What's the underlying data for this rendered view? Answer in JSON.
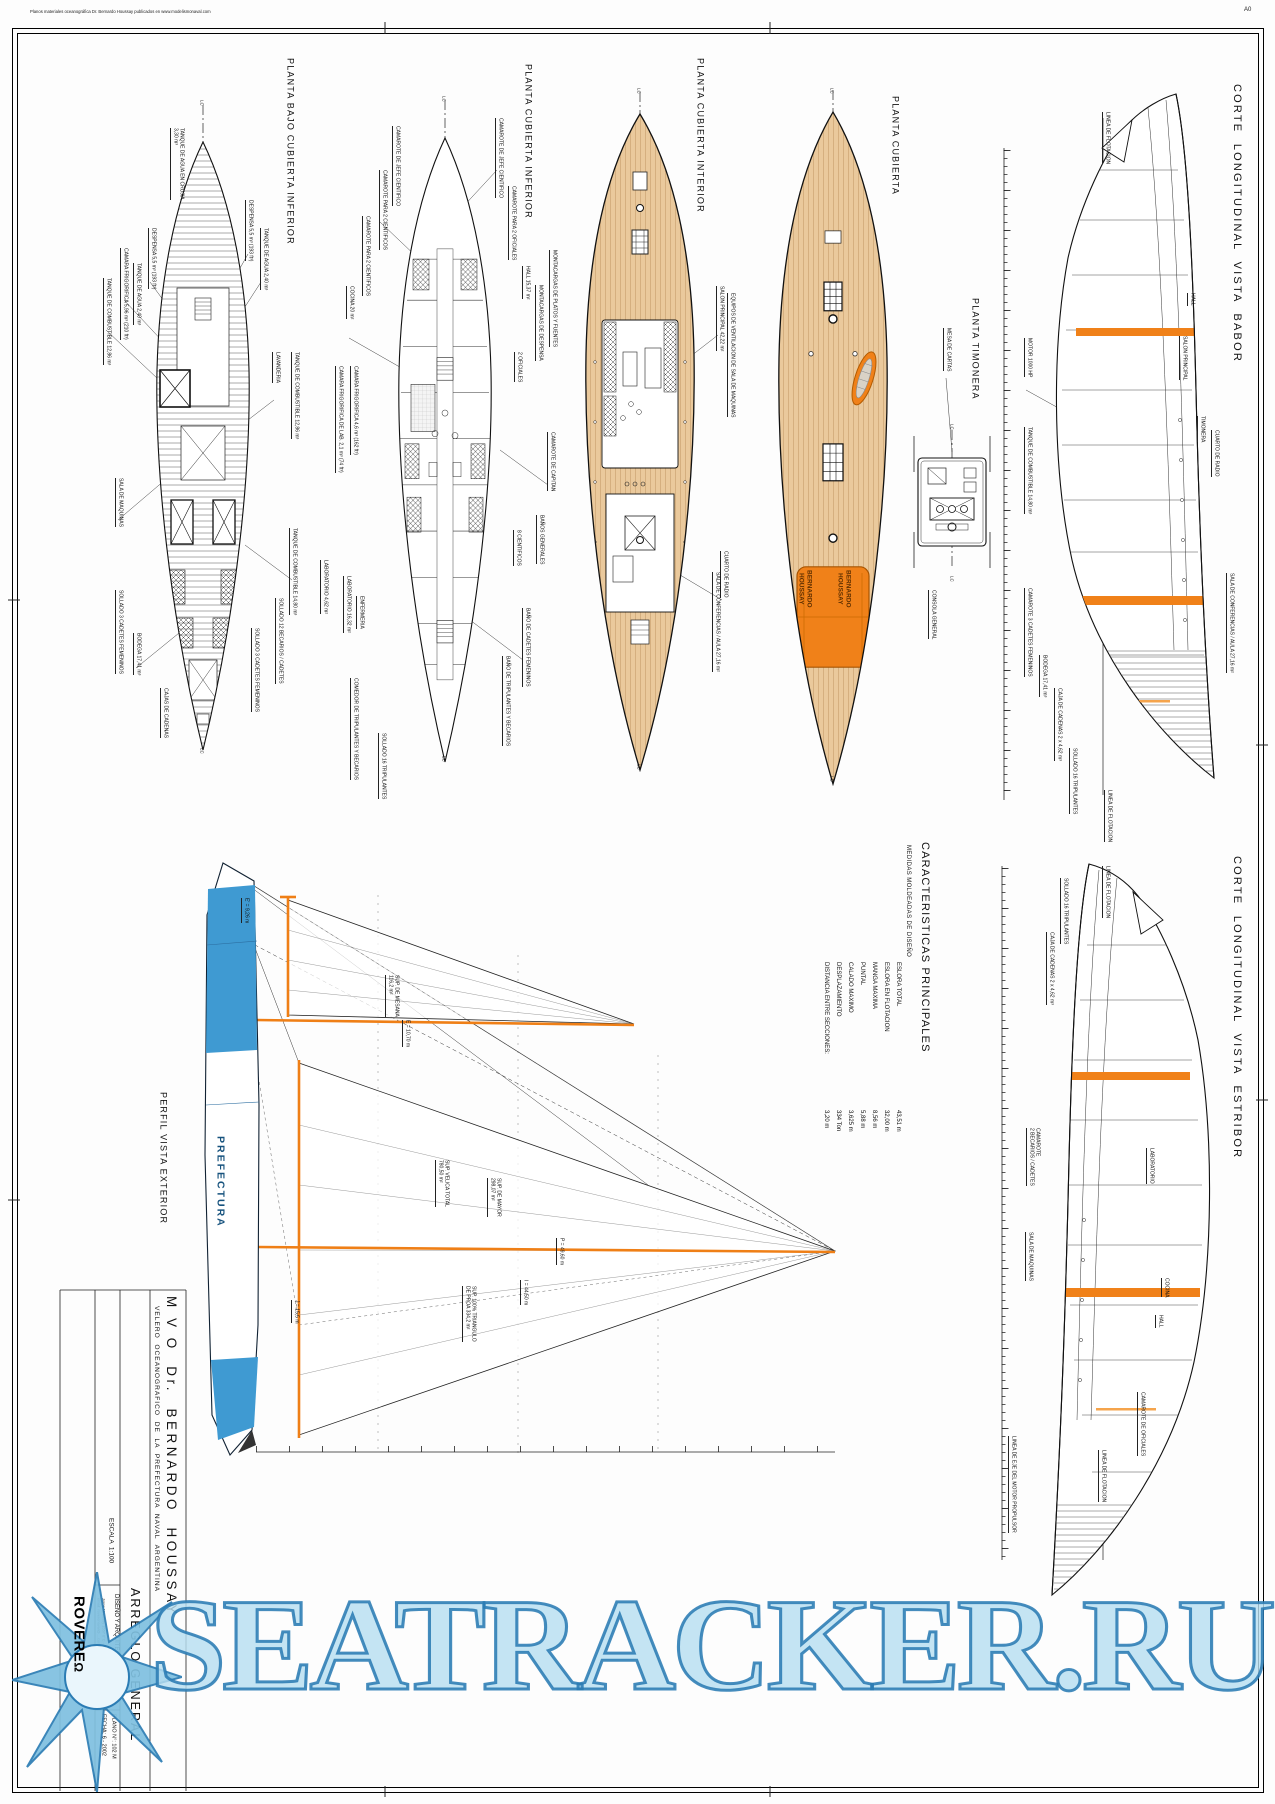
{
  "page": {
    "note": "Planos materiales oceanográfica Dr. Bernardo Houssay publicados en www.modelismonaval.com",
    "sheet_size": "A0"
  },
  "watermark": {
    "text": "SEATRACKER.RU",
    "fill": "#b7def0",
    "stroke": "#2b7cb4"
  },
  "colors": {
    "accent_orange": "#f08119",
    "deck_tan": "#eac99c",
    "hull_blue": "#3f9ad2",
    "watermark_blue": "#2b7cb4",
    "line_black": "#111111"
  },
  "title_block": {
    "vessel_name": "M V O  Dr.  BERNARDO  HOUSSAY",
    "vessel_type": "VELERO  OCEANOGRAFICO  DE  LA  PREFECTURA  NAVAL  ARGENTINA",
    "drawing_title": "ARREGLO GENERAL",
    "scale": "ESCALA  1:100",
    "firm": "DISEÑO Y ARQUITECTURA NAVAL",
    "logo": "ROVERE",
    "logo_mark": "Ω",
    "address1": "Jorge Newbery 1557 6°C - C1426CXA Buenos Aires - Tel.",
    "address2": "email: roverenaval@....com.ar",
    "plan_number": "PLANO N°: 102 M",
    "date": "FECHA: 6 - 2002"
  },
  "characteristics": {
    "title": "CARACTERISTICAS PRINCIPALES",
    "subtitle": "MEDIDAS MOLDEADAS DE DISEÑO",
    "label_y": 962,
    "value_y": 1110,
    "items": [
      {
        "label": "ESLORA TOTAL",
        "value": "43,51 m",
        "x": 894
      },
      {
        "label": "ESLORA EN FLOTACION",
        "value": "32,00 m",
        "x": 882
      },
      {
        "label": "MANGA MAXIMA",
        "value": "8,56 m",
        "x": 870
      },
      {
        "label": "PUNTAL",
        "value": "5,88 m",
        "x": 858
      },
      {
        "label": "CALADO MAXIMO",
        "value": "3,625 m",
        "x": 846
      },
      {
        "label": "DESPLAZAMIENTO",
        "value": "334 Ton",
        "x": 834
      },
      {
        "label": "DISTANCIA ENTRE SECCIONES:",
        "value": "3,20 m",
        "x": 822
      }
    ]
  },
  "callout_groups": [
    {
      "name": "drawing-title",
      "labels": [
        {
          "t": "PLANTA BAJO CUBIERTA INFERIOR",
          "x": 285,
          "y": 58,
          "cls": "tp"
        },
        {
          "t": "PLANTA CUBIERTA INFERIOR",
          "x": 523,
          "y": 64,
          "cls": "tp"
        },
        {
          "t": "PLANTA CUBIERTA INTERIOR",
          "x": 695,
          "y": 58,
          "cls": "tp"
        },
        {
          "t": "PLANTA CUBIERTA",
          "x": 890,
          "y": 96,
          "cls": "tp"
        },
        {
          "t": "PLANTA TIMONERA",
          "x": 970,
          "y": 298,
          "cls": "tp"
        },
        {
          "t": "CORTE  LONGITUDINAL  VISTA  BABOR",
          "x": 1230,
          "y": 84,
          "cls": "ts"
        },
        {
          "t": "CORTE  LONGITUDINAL  VISTA  ESTRIBOR",
          "x": 1230,
          "y": 856,
          "cls": "ts"
        },
        {
          "t": "PERFIL VISTA EXTERIOR",
          "x": 158,
          "y": 1092,
          "cls": "tp"
        }
      ]
    },
    {
      "name": "plan-bajo-cubierta-inferior",
      "labels": [
        {
          "t": "LC",
          "x": 199,
          "y": 100,
          "cls": "lc"
        },
        {
          "t": "TANQUE DE AGUA EN CRUJIA\n3,30 m³",
          "x": 170,
          "y": 128
        },
        {
          "t": "DESPENSA 5,5 m³ (193 ft³)",
          "x": 245,
          "y": 200
        },
        {
          "t": "TANQUE DE AGUA 2,40 m³",
          "x": 260,
          "y": 228
        },
        {
          "t": "DESPENSA 5,5 m³ (193 ft³)",
          "x": 148,
          "y": 228
        },
        {
          "t": "CAMARA FRIGORIFICA 5,96 m³ (210 ft³)",
          "x": 120,
          "y": 248
        },
        {
          "t": "TANQUE DE AGUA 2,40 m³",
          "x": 133,
          "y": 263
        },
        {
          "t": "TANQUE DE COMBUSTIBLE 12,86 m³",
          "x": 103,
          "y": 278
        },
        {
          "t": "LAVANDERIA",
          "x": 272,
          "y": 352
        },
        {
          "t": "TANQUE DE COMBUSTIBLE 12,86 m³",
          "x": 291,
          "y": 352
        },
        {
          "t": "SALA DE MAQUINAS",
          "x": 115,
          "y": 478
        },
        {
          "t": "TANQUE DE COMBUSTIBLE 14,80 m³",
          "x": 289,
          "y": 528
        },
        {
          "t": "SOLLADO 12 BECARIOS / CADETES",
          "x": 275,
          "y": 598
        },
        {
          "t": "SOLLADO 3 CADETES FEMENINOS",
          "x": 115,
          "y": 590
        },
        {
          "t": "BODEGA 17,41 m³",
          "x": 133,
          "y": 633
        },
        {
          "t": "SOLLADO 3 CADETES FEMENINOS",
          "x": 251,
          "y": 628
        },
        {
          "t": "CAJAS DE CADENAS",
          "x": 160,
          "y": 688
        },
        {
          "t": "LC",
          "x": 199,
          "y": 748,
          "cls": "lc"
        }
      ]
    },
    {
      "name": "plan-cubierta-inferior",
      "labels": [
        {
          "t": "LC",
          "x": 441,
          "y": 96,
          "cls": "lc"
        },
        {
          "t": "CAMAROTE DE JEFE CIENTIFICO",
          "x": 495,
          "y": 118
        },
        {
          "t": "CAMAROTE DE JEFE CIENTIFICO",
          "x": 392,
          "y": 126
        },
        {
          "t": "CAMAROTE PARA 2 CIENTIFICOS",
          "x": 379,
          "y": 170
        },
        {
          "t": "CAMAROTE PARA 2 OFICIALES",
          "x": 508,
          "y": 186
        },
        {
          "t": "CAMAROTE PARA 2 CIENTIFICOS",
          "x": 362,
          "y": 216
        },
        {
          "t": "MONTACARGAS DE PLATOS Y FUENTES",
          "x": 549,
          "y": 250
        },
        {
          "t": "HALL 15,37 m²",
          "x": 522,
          "y": 266
        },
        {
          "t": "MONTACARGAS DE DESPENSA",
          "x": 535,
          "y": 285
        },
        {
          "t": "COCINA 20 m²",
          "x": 346,
          "y": 286
        },
        {
          "t": "2 OFICIALES",
          "x": 514,
          "y": 352
        },
        {
          "t": "CAMARA FRIGORIFICA 4,6 m³ (162 ft³)",
          "x": 350,
          "y": 366
        },
        {
          "t": "CAMARA FRIGORIFICA DE LAB. 2,1 m³ (74 ft³)",
          "x": 335,
          "y": 366
        },
        {
          "t": "CAMAROTE DE CAPITAN",
          "x": 547,
          "y": 432
        },
        {
          "t": "BAÑOS GENERALES",
          "x": 536,
          "y": 515
        },
        {
          "t": "8 CIENTIFICOS",
          "x": 513,
          "y": 530
        },
        {
          "t": "LABORATORIO 4,62 m²",
          "x": 320,
          "y": 560
        },
        {
          "t": "LABORATORIO 16,32 m²",
          "x": 343,
          "y": 576
        },
        {
          "t": "ENFERMERIA",
          "x": 356,
          "y": 596
        },
        {
          "t": "BAÑO DE CADETES FEMENINOS",
          "x": 522,
          "y": 608
        },
        {
          "t": "BAÑO DE TRIPULANTES Y BECARIOS",
          "x": 502,
          "y": 656
        },
        {
          "t": "COMEDOR DE TRIPULANTES Y BECARIOS",
          "x": 350,
          "y": 678
        },
        {
          "t": "SOLLADO 16 TRIPULANTES",
          "x": 378,
          "y": 733
        },
        {
          "t": "LC",
          "x": 441,
          "y": 756,
          "cls": "lc"
        }
      ]
    },
    {
      "name": "plan-cubierta-interior",
      "labels": [
        {
          "t": "LC",
          "x": 636,
          "y": 88,
          "cls": "lc"
        },
        {
          "t": "SALON PRINCIPAL 42,22 m²",
          "x": 716,
          "y": 286
        },
        {
          "t": "EQUIPOS DE VENTILACION DE SALA DE MAQUINAS",
          "x": 727,
          "y": 293
        },
        {
          "t": "CUARTO DE RADIO",
          "x": 720,
          "y": 551
        },
        {
          "t": "SALA DE CONFERENCIAS / AULA 27,16 m²",
          "x": 712,
          "y": 572
        },
        {
          "t": "LC",
          "x": 636,
          "y": 764,
          "cls": "lc"
        }
      ]
    },
    {
      "name": "plan-cubierta",
      "labels": [
        {
          "t": "LC",
          "x": 829,
          "y": 88,
          "cls": "lc"
        },
        {
          "t": "BERNARDO\nHOUSSAY",
          "x": 797,
          "y": 570,
          "cls": "house"
        },
        {
          "t": "BERNARDO\nHOUSSAY",
          "x": 836,
          "y": 570,
          "cls": "house"
        },
        {
          "t": "LC",
          "x": 829,
          "y": 776,
          "cls": "lc"
        }
      ]
    },
    {
      "name": "plan-timonera",
      "labels": [
        {
          "t": "MESA DE CARTAS",
          "x": 943,
          "y": 328
        },
        {
          "t": "LC",
          "x": 949,
          "y": 424,
          "cls": "lc"
        },
        {
          "t": "LC",
          "x": 949,
          "y": 576,
          "cls": "lc"
        },
        {
          "t": "CONSOLA GENERAL",
          "x": 928,
          "y": 590
        }
      ]
    },
    {
      "name": "corte-babor",
      "labels": [
        {
          "t": "LINEA DE FLOTACION",
          "x": 1102,
          "y": 112
        },
        {
          "t": "HALL",
          "x": 1187,
          "y": 293
        },
        {
          "t": "SALON PRINCIPAL",
          "x": 1179,
          "y": 336
        },
        {
          "t": "MOTOR 1000 HP",
          "x": 1024,
          "y": 338
        },
        {
          "t": "TIMONERA",
          "x": 1197,
          "y": 416
        },
        {
          "t": "TANQUE DE COMBUSTIBLE 14,80 m³",
          "x": 1024,
          "y": 427
        },
        {
          "t": "CUARTO DE RADIO",
          "x": 1211,
          "y": 430
        },
        {
          "t": "SALA DE CONFERENCIAS / AULA 27,16 m²",
          "x": 1226,
          "y": 573
        },
        {
          "t": "CAMAROTE 3 CADETES FEMENINOS",
          "x": 1024,
          "y": 588
        },
        {
          "t": "BODEGA 17,41 m³",
          "x": 1039,
          "y": 655
        },
        {
          "t": "CAJA DE CADENAS 2 x 4,62 m³",
          "x": 1054,
          "y": 688
        },
        {
          "t": "SOLLADO 16 TRIPULANTES",
          "x": 1069,
          "y": 748
        },
        {
          "t": "LINEA DE FLOTACION",
          "x": 1104,
          "y": 790
        }
      ]
    },
    {
      "name": "corte-estribor",
      "labels": [
        {
          "t": "LINEA DE FLOTACION",
          "x": 1102,
          "y": 866
        },
        {
          "t": "SOLLADO 16 TRIPULANTES",
          "x": 1060,
          "y": 878
        },
        {
          "t": "CAJA DE CADENAS 2 x 4,62 m³",
          "x": 1046,
          "y": 932
        },
        {
          "t": "CAMAROTE\n2 BECARIOS / CADETES",
          "x": 1026,
          "y": 1128
        },
        {
          "t": "LABORATORIO",
          "x": 1146,
          "y": 1148
        },
        {
          "t": "SALA DE MAQUINAS",
          "x": 1025,
          "y": 1232
        },
        {
          "t": "COCINA",
          "x": 1161,
          "y": 1278
        },
        {
          "t": "HALL",
          "x": 1155,
          "y": 1315
        },
        {
          "t": "CAMAROTE DE OFICIALES",
          "x": 1137,
          "y": 1392
        },
        {
          "t": "LINEA DE EJE DEL MOTOR PROPULSOR",
          "x": 1008,
          "y": 1436
        },
        {
          "t": "LINEA DE FLOTACION",
          "x": 1098,
          "y": 1450
        }
      ]
    },
    {
      "name": "perfil-exterior",
      "labels": [
        {
          "t": "E' = 9,26 m",
          "x": 241,
          "y": 898
        },
        {
          "t": "SUP. DE MESANA\n116,2 m²",
          "x": 385,
          "y": 975
        },
        {
          "t": "E = 10,70 m",
          "x": 402,
          "y": 1020
        },
        {
          "t": "PREFECTURA",
          "x": 214,
          "y": 1136,
          "cls": "pref"
        },
        {
          "t": "SUP. VELICA TOTAL\n780,50 m²",
          "x": 435,
          "y": 1160
        },
        {
          "t": "SUP. DE MAYOR\n298,07 m²",
          "x": 487,
          "y": 1178
        },
        {
          "t": "P = 49,60 m",
          "x": 556,
          "y": 1238
        },
        {
          "t": "I = 44,50 m",
          "x": 520,
          "y": 1280
        },
        {
          "t": "SUP. 100% TRIANGULO\nDE PROA 334,2 m²",
          "x": 462,
          "y": 1286
        },
        {
          "t": "J = 15,5 m",
          "x": 291,
          "y": 1300
        }
      ]
    },
    {
      "name": "title-block",
      "labels": [
        {
          "t": "M V O  Dr.  BERNARDO  HOUSSAY",
          "x": 163,
          "y": 1296,
          "cls": "name"
        },
        {
          "t": "VELERO  OCEANOGRAFICO  DE  LA  PREFECTURA  NAVAL  ARGENTINA",
          "x": 152,
          "y": 1306,
          "cls": "vtype"
        },
        {
          "t": "ESCALA  1:100",
          "x": 107,
          "y": 1518,
          "cls": "esc"
        },
        {
          "t": "ARREGLO GENERAL",
          "x": 127,
          "y": 1588,
          "cls": "arr"
        },
        {
          "t": "DISEÑO Y ARQUITECTURA NAVAL",
          "x": 112,
          "y": 1594,
          "cls": "dis"
        },
        {
          "t": "Jorge Newbery 1557 6°C - C1426CXA Buenos Aires - Tel.",
          "x": 101,
          "y": 1598,
          "cls": "addr"
        },
        {
          "t": "email: roverenaval@....com.ar",
          "x": 96,
          "y": 1598,
          "cls": "addr"
        },
        {
          "t": "PLANO N°: 102 M",
          "x": 110,
          "y": 1714,
          "cls": "pl"
        },
        {
          "t": "FECHA: 6 - 2002",
          "x": 100,
          "y": 1714,
          "cls": "pl"
        }
      ]
    }
  ]
}
